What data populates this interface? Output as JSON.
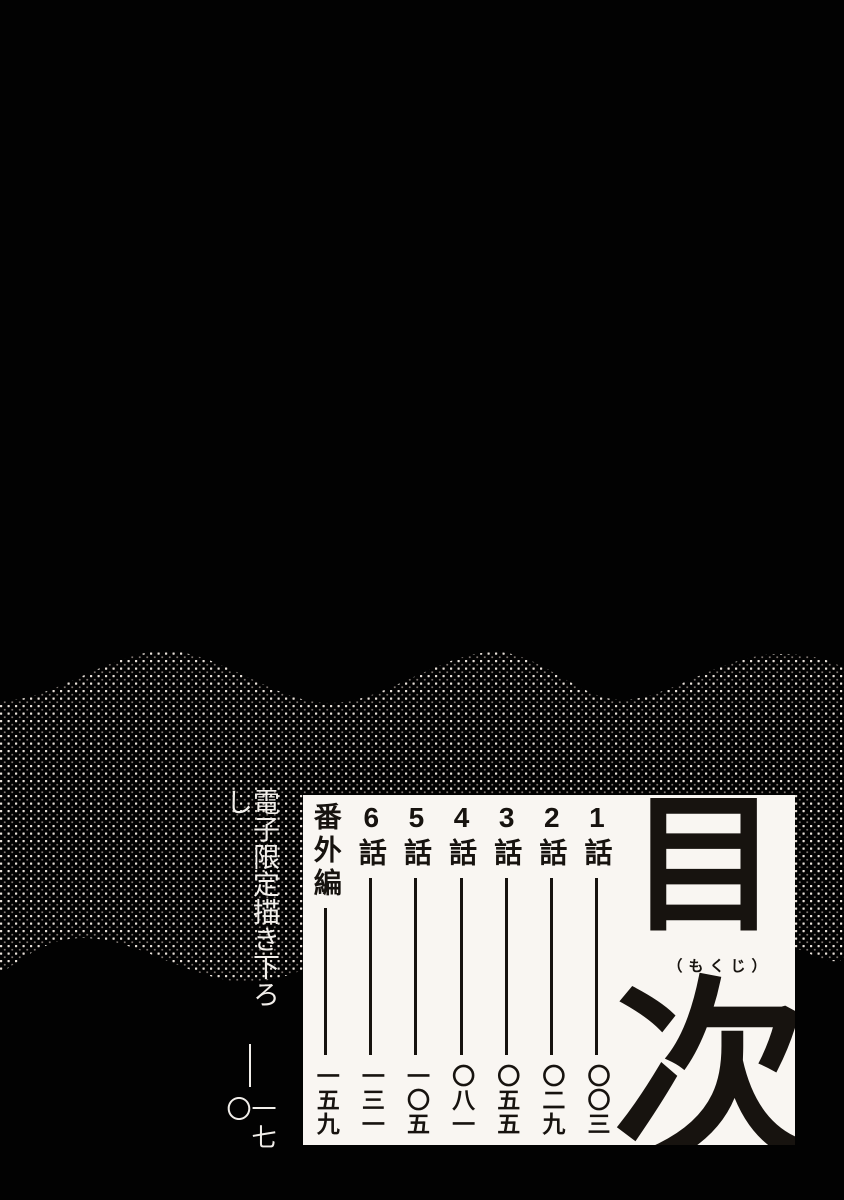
{
  "colors": {
    "background": "#020202",
    "paper": "#f9f6f2",
    "ink": "#17130f",
    "white_text": "#f1eeea",
    "dot_bright": "#e9e1da",
    "dot_dim": "#7d7470"
  },
  "toc": {
    "title": "目次",
    "title_char_1": "目",
    "title_char_2": "次",
    "furigana": "（もくじ）",
    "entries": [
      {
        "label": "1話",
        "page": "〇〇三"
      },
      {
        "label": "2話",
        "page": "〇二九"
      },
      {
        "label": "3話",
        "page": "〇五五"
      },
      {
        "label": "4話",
        "page": "〇八一"
      },
      {
        "label": "5話",
        "page": "一〇五"
      },
      {
        "label": "6話",
        "page": "一三一"
      },
      {
        "label": "番外編",
        "page": "一五九"
      }
    ],
    "bonus": {
      "label": "電子限定描き下ろし",
      "page": "一七〇"
    }
  }
}
